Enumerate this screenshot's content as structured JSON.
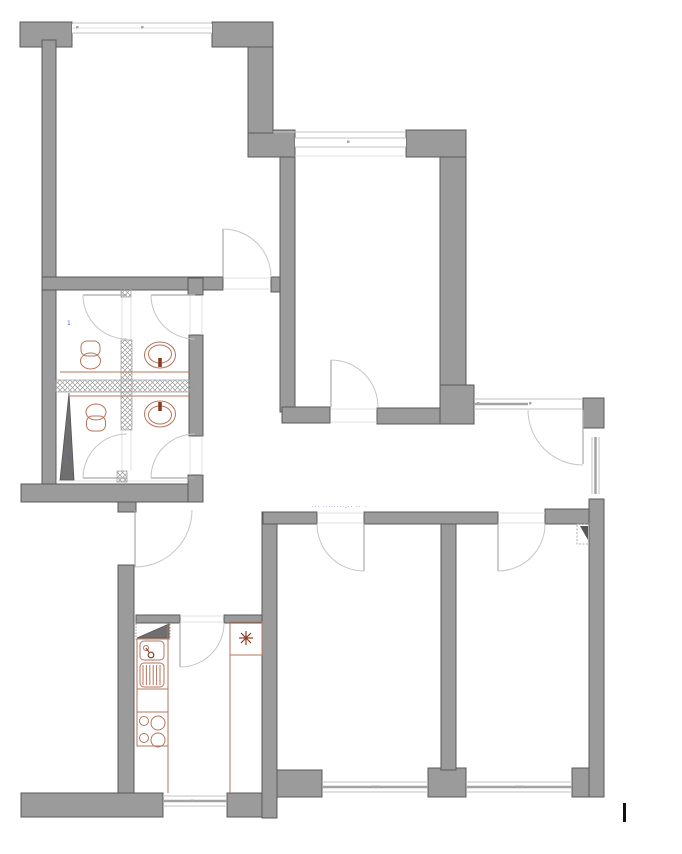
{
  "canvas": {
    "width": 682,
    "height": 854,
    "background": "#ffffff"
  },
  "palette": {
    "wall_fill": "#9b9b9b",
    "wall_stroke": "#5a5a5a",
    "partition_line": "#c2c2c2",
    "door_arc": "#c5c5c5",
    "fixture_outline": "#b5755c",
    "fixture_accent": "#8a3c22",
    "shaft_fill": "#6f6f6f",
    "annotation_blue": "#4a5fd0",
    "cursor_black": "#111111"
  },
  "annotations": {
    "layer_note": "··· ········,·· ·· ·",
    "upper_wc_mark": "1",
    "lower_wc_mark": "1"
  },
  "icons": {
    "heater_star": "8-spoke-asterisk",
    "shaft_triangle": "filled-wedge",
    "vent_marker": "dashed-box-wedge",
    "cursor_bar": "vertical-bar"
  }
}
